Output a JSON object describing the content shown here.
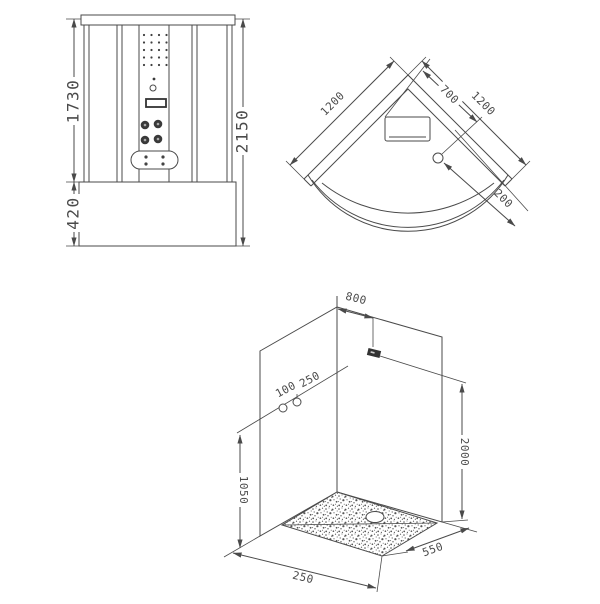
{
  "title": "shower-cabin-technical-drawing",
  "colors": {
    "line": "#4a4a4a",
    "background": "#ffffff",
    "outlet_fill": "#333333"
  },
  "front_view": {
    "dims": {
      "body_height": "1730",
      "base_height": "420",
      "total_height": "2150"
    }
  },
  "plan_view": {
    "dims": {
      "left_wall": "1200",
      "right_wall": "1200",
      "seat_width": "700",
      "drain_offset": "200"
    }
  },
  "iso_view": {
    "dims": {
      "outlet_from_corner": "800",
      "supply_offset_1": "100",
      "supply_offset_2": "250",
      "outlet_height": "2000",
      "supply_height": "1050",
      "tray_front_left": "250",
      "tray_front_right": "550"
    }
  }
}
